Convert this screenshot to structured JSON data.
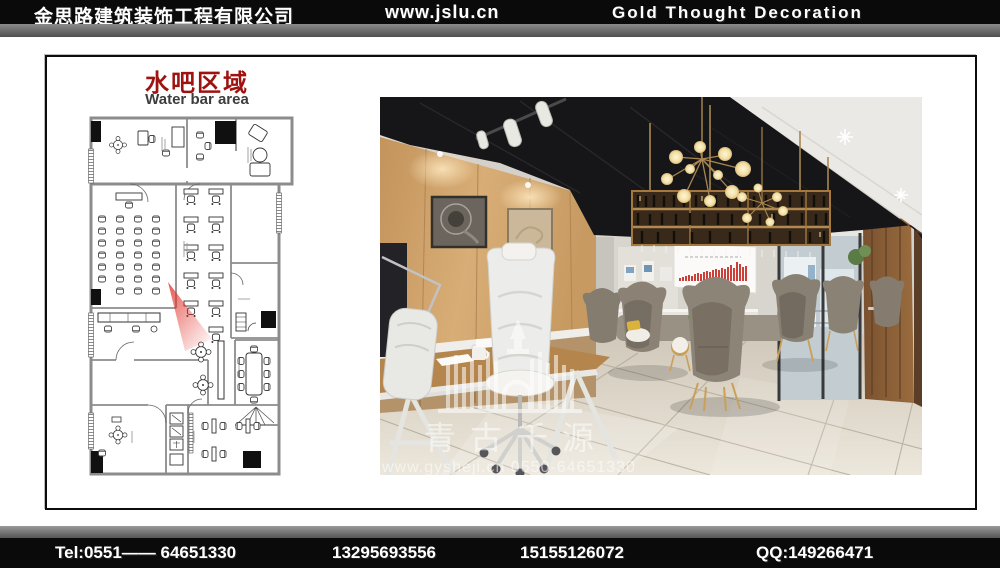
{
  "header": {
    "company_cn": "金思路建筑装饰工程有限公司",
    "site": "www.jslu.cn",
    "company_en": "Gold Thought Decoration"
  },
  "plan": {
    "title_cn": "水吧区域",
    "title_en": "Water bar area"
  },
  "photo": {
    "watermark_name": "青古千源",
    "watermark_contact": "www.gysheji.cn  0550-64651330"
  },
  "footer": {
    "items": [
      "Tel:0551—— 64651330",
      "13295693556",
      "15155126072",
      "QQ:149266471"
    ]
  },
  "colors": {
    "title_red": "#9e1210",
    "art_bar_red": "#c62b24",
    "view_cone_red": "#e03028",
    "bar_background": "#0a0a0a"
  }
}
